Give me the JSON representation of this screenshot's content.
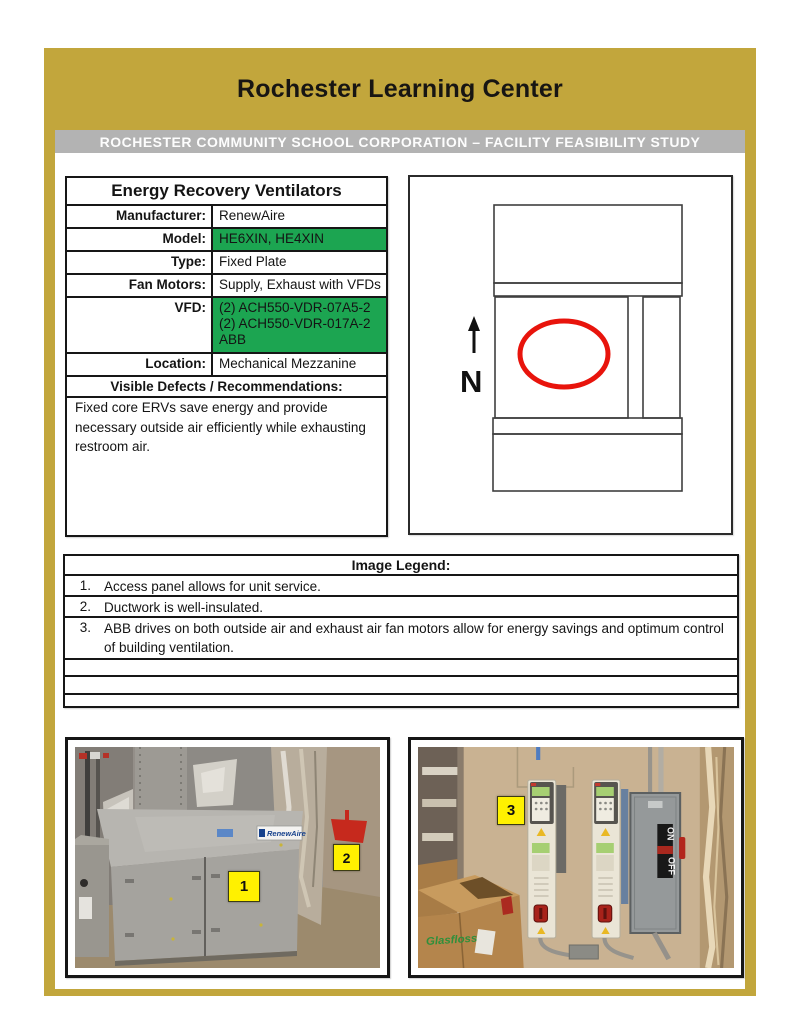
{
  "page": {
    "title": "Rochester Learning Center",
    "banner": "ROCHESTER COMMUNITY SCHOOL CORPORATION – FACILITY FEASIBILITY STUDY"
  },
  "colors": {
    "gold": "#C2A63C",
    "banner_gray": "#B3B3B3",
    "highlight_green": "#1CA551",
    "label_yellow": "#FFF100",
    "plan_red": "#E8140C"
  },
  "spec_table": {
    "title": "Energy Recovery Ventilators",
    "rows": [
      {
        "label": "Manufacturer:",
        "value": "RenewAire"
      },
      {
        "label": "Model:",
        "value": "HE6XIN, HE4XIN"
      },
      {
        "label": "Type:",
        "value": "Fixed Plate"
      },
      {
        "label": "Fan Motors:",
        "value": "Supply, Exhaust with VFDs"
      },
      {
        "label": "VFD:",
        "value_lines": [
          "(2) ACH550-VDR-07A5-2",
          "(2) ACH550-VDR-017A-2",
          "ABB"
        ]
      },
      {
        "label": "Location:",
        "value": "Mechanical Mezzanine"
      }
    ],
    "defects_header": "Visible Defects / Recommendations:",
    "notes": "Fixed core ERVs save energy and provide necessary outside air efficiently while exhausting restroom air."
  },
  "floor_plan": {
    "north_label": "N"
  },
  "image_legend": {
    "title": "Image Legend:",
    "items": [
      {
        "num": "1.",
        "text": "Access panel allows for unit service."
      },
      {
        "num": "2.",
        "text": "Ductwork is well-insulated."
      },
      {
        "num": "3.",
        "text": "ABB drives on both outside air and exhaust air fan motors allow for energy savings and optimum control of building ventilation."
      }
    ]
  },
  "photos": {
    "left": {
      "marker_1": "1",
      "marker_2": "2",
      "unit_label": "RenewAire"
    },
    "right": {
      "marker_3": "3",
      "switch_on": "ON",
      "switch_off": "OFF",
      "box_brand": "Glasfloss"
    }
  }
}
